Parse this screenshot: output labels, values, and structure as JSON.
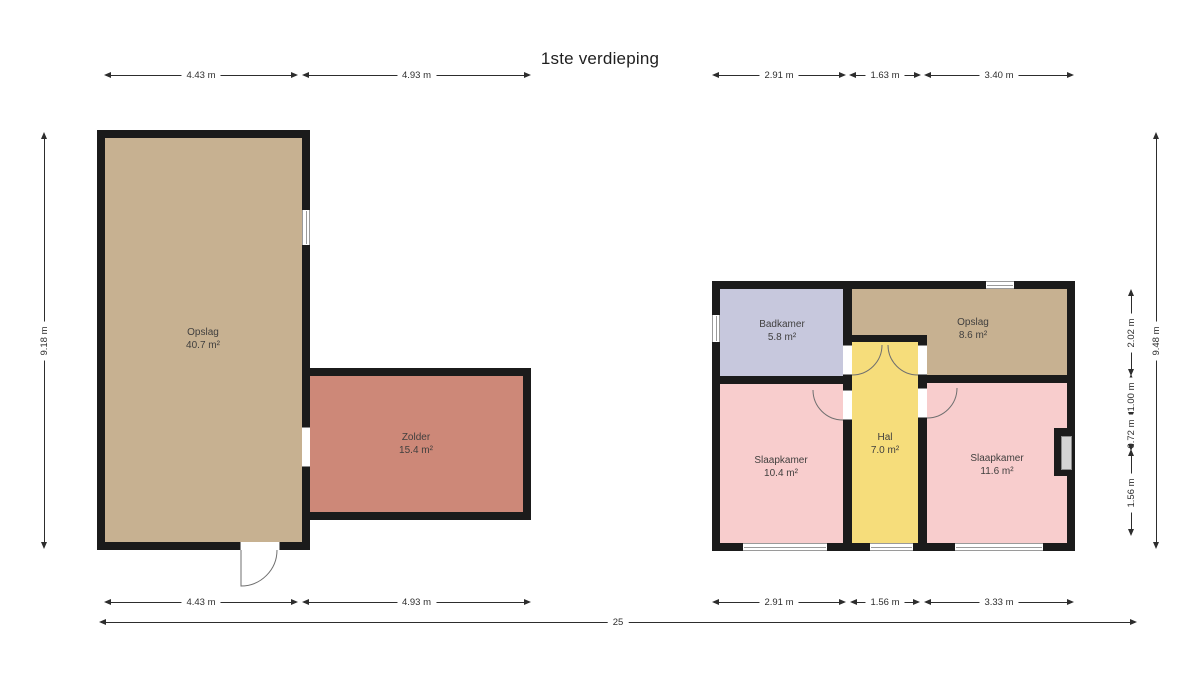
{
  "title": "1ste verdieping",
  "rooms": {
    "opslag_left": {
      "name": "Opslag",
      "area": "40.7 m²"
    },
    "zolder": {
      "name": "Zolder",
      "area": "15.4 m²"
    },
    "badkamer": {
      "name": "Badkamer",
      "area": "5.8 m²"
    },
    "opslag_right": {
      "name": "Opslag",
      "area": "8.6 m²"
    },
    "slaapkamer_left": {
      "name": "Slaapkamer",
      "area": "10.4 m²"
    },
    "hal": {
      "name": "Hal",
      "area": "7.0 m²"
    },
    "slaapkamer_right": {
      "name": "Slaapkamer",
      "area": "11.6 m²"
    }
  },
  "dimensions": {
    "top_left_1": "4.43 m",
    "top_left_2": "4.93 m",
    "top_right_1": "2.91 m",
    "top_right_2": "1.63 m",
    "top_right_3": "3.40 m",
    "bottom_left_1": "4.43 m",
    "bottom_left_2": "4.93 m",
    "bottom_right_1": "2.91 m",
    "bottom_right_2": "1.56 m",
    "bottom_right_3": "3.33 m",
    "left_height": "9.18 m",
    "right_seg_1": "2.02 m",
    "right_seg_2": "1.00 m",
    "right_seg_3": "0.72 m",
    "right_seg_4": "1.56 m",
    "right_total": "9.48 m",
    "overall_width": "25"
  },
  "colors": {
    "wall": "#1b1b1b",
    "opslag": "#c7b191",
    "zolder": "#cd8878",
    "badkamer": "#c7c8dd",
    "hal": "#f6dd7b",
    "slaapkamer": "#f8cdcd"
  }
}
